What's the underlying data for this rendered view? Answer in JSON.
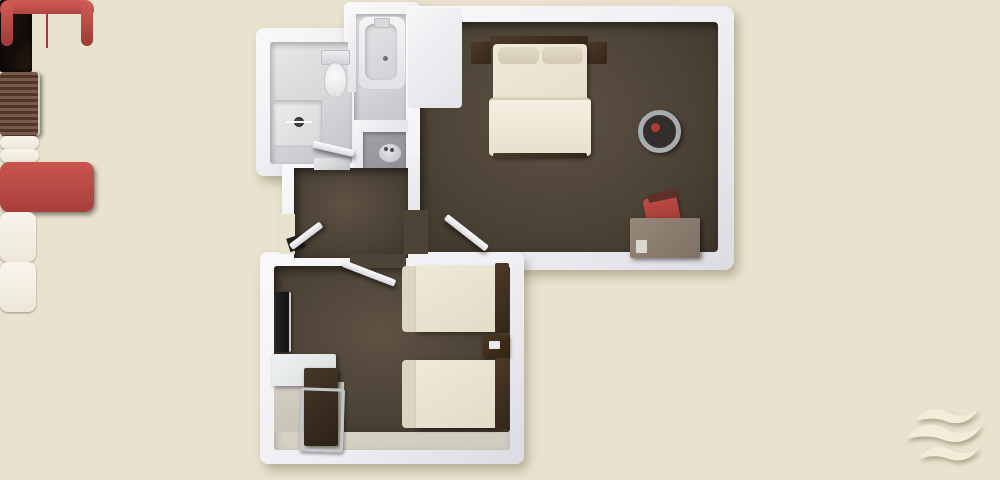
{
  "scene": {
    "label": "3D top-down rendered floor plan of a hotel suite: king bedroom with red loveseat, twin-bed room, bathroom with shower and tub, vanity nook and entry hallway",
    "type": "floorplan-3d-render",
    "background_color": "#e9e2cf"
  },
  "palette": {
    "wall_white": "#f1f1f4",
    "carpet_brown": "#4d4336",
    "bathroom_tile": "#d9d9dc",
    "bedding_cream": "#ece6d4",
    "wood_dark": "#40301f",
    "sofa_red": "#bd4c47",
    "chair_red": "#ac423d",
    "desk_taupe": "#897b6f",
    "floor_light": "#d8d4c8",
    "table_ring_silver": "#a7acaf"
  },
  "rooms": [
    {
      "name": "bathroom",
      "fixtures": [
        "walk-in-shower",
        "toilet",
        "bathtub"
      ]
    },
    {
      "name": "vanity-nook",
      "fixtures": [
        "sink-counter"
      ]
    },
    {
      "name": "entry-hallway",
      "fixtures": [
        "entry-door",
        "open-closet",
        "louvered-chest"
      ]
    },
    {
      "name": "king-bedroom",
      "furniture": [
        "king-bed",
        "headboard-with-side-tables",
        "red-loveseat",
        "round-side-table",
        "writing-desk",
        "red-desk-chair"
      ]
    },
    {
      "name": "twin-bedroom",
      "furniture": [
        "twin-bed-upper",
        "twin-bed-lower",
        "nightstand-with-phone",
        "wall-mounted-tv",
        "desk-with-chrome-chair",
        "dark-cabinet"
      ]
    }
  ],
  "logo": {
    "name": "embossed-triple-wave-emblem",
    "position": "bottom-right"
  }
}
